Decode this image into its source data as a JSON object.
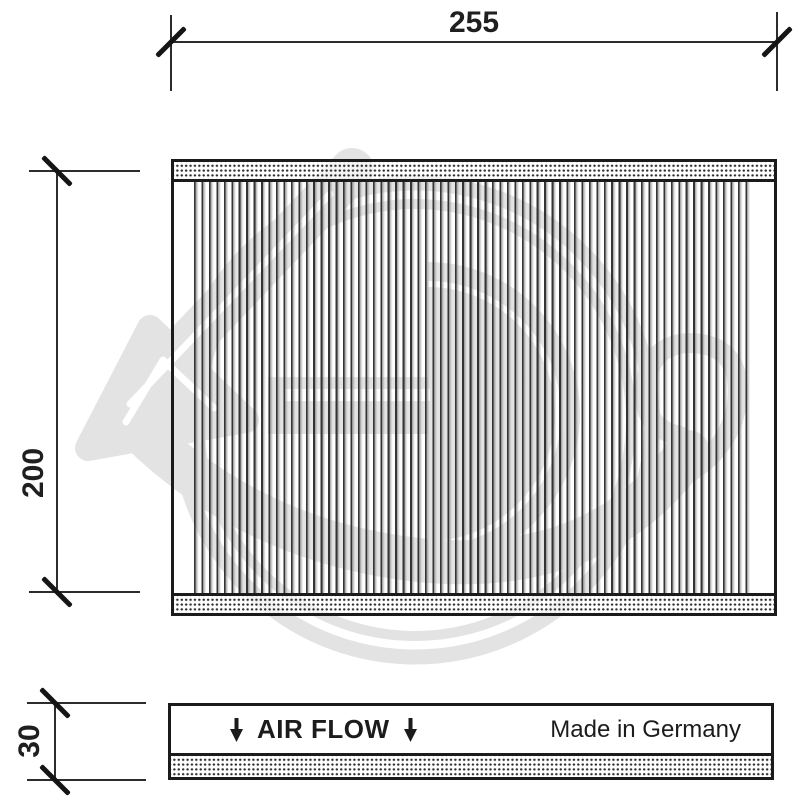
{
  "drawing": {
    "type": "technical-drawing-cabin-air-filter",
    "dimensions": {
      "width": "255",
      "height": "200",
      "depth": "30"
    },
    "side_view": {
      "air_flow": "AIR FLOW",
      "origin": "Made in Germany",
      "arrow_icon": "down-arrow-icon"
    },
    "colors": {
      "line": "#1b1b1b",
      "dimension_text": "#1f1f1f",
      "watermark": "#e3e3e3",
      "pleat_dark": "#2a2a2a",
      "pleat_shade": "#a5a5a5"
    }
  }
}
